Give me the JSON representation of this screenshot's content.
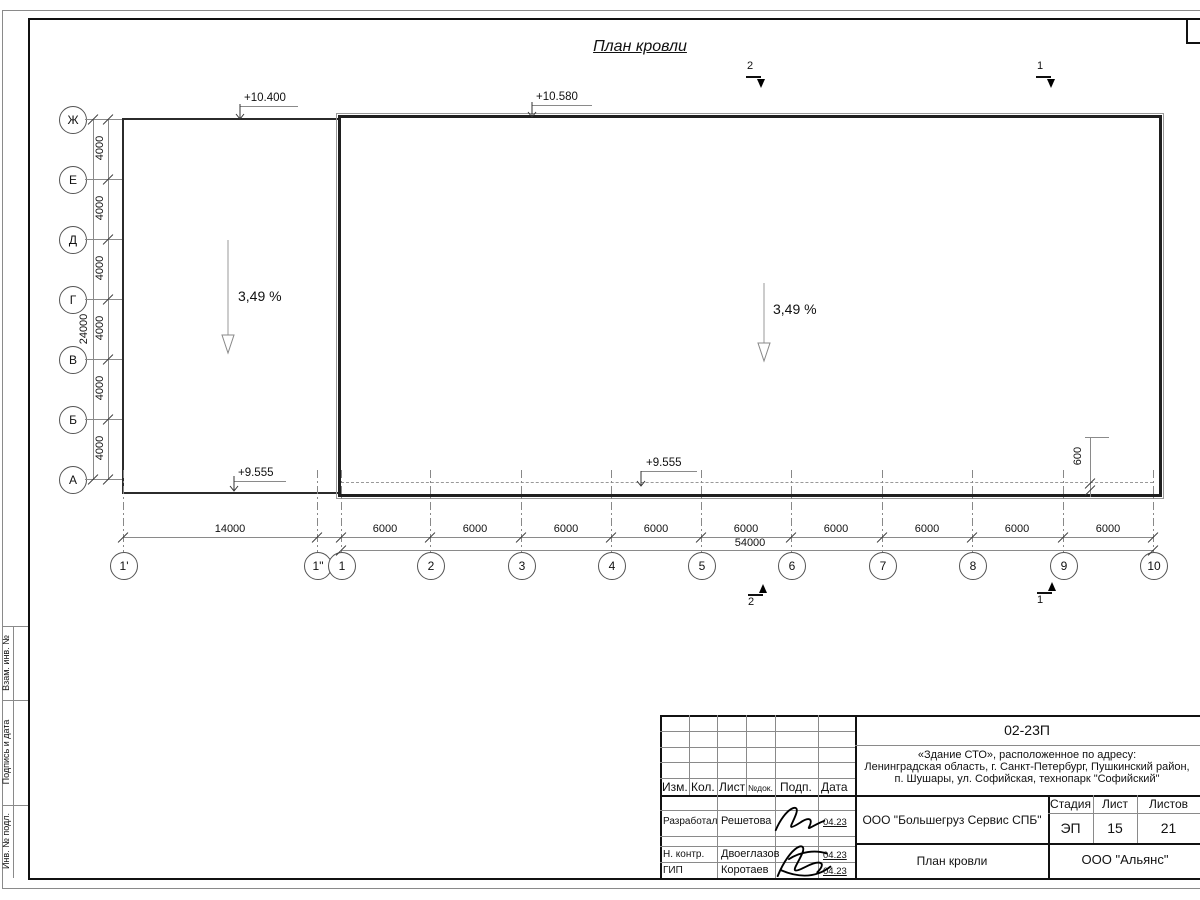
{
  "drawing": {
    "title": "План кровли"
  },
  "elevations": {
    "left_top": "+10.400",
    "main_top": "+10.580",
    "left_bottom": "+9.555",
    "main_bottom": "+9.555"
  },
  "slopes": {
    "left": "3,49 %",
    "right": "3,49 %"
  },
  "axes": {
    "letters": [
      "Ж",
      "Е",
      "Д",
      "Г",
      "В",
      "Б",
      "А"
    ],
    "numbers": [
      "1'",
      "1\"",
      "1",
      "2",
      "3",
      "4",
      "5",
      "6",
      "7",
      "8",
      "9",
      "10"
    ]
  },
  "dimensions": {
    "vertical_segments": [
      "4000",
      "4000",
      "4000",
      "4000",
      "4000",
      "4000"
    ],
    "vertical_total": "24000",
    "first_bay": "14000",
    "bays": [
      "6000",
      "6000",
      "6000",
      "6000",
      "6000",
      "6000",
      "6000",
      "6000",
      "6000"
    ],
    "total": "54000",
    "overhang": "600"
  },
  "section_marks": {
    "top_left": "2",
    "top_right": "1",
    "bottom_left": "2",
    "bottom_right": "1"
  },
  "frame_strip": {
    "vzam": "Взам. инв. №",
    "podpis": "Подпись и дата",
    "inv": "Инв. № подл."
  },
  "title_block": {
    "doc_number": "02-23П",
    "project_line1": "«Здание СТО», расположенное по адресу:",
    "project_line2": "Ленинградская область, г. Санкт-Петербург, Пушкинский район,",
    "project_line3": "п. Шушары, ул. Софийская, технопарк \"Софийский\"",
    "columns": [
      "Изм.",
      "Кол.",
      "Лист",
      "№док.",
      "Подп.",
      "Дата"
    ],
    "rows": [
      {
        "role": "Разработал",
        "name": "Решетова",
        "date": "04.23"
      },
      {
        "role": "Н. контр.",
        "name": "Двоеглазов",
        "date": "04.23"
      },
      {
        "role": "ГИП",
        "name": "Коротаев",
        "date": "04.23"
      }
    ],
    "stage_label": "Стадия",
    "sheet_label": "Лист",
    "sheets_label": "Листов",
    "stage": "ЭП",
    "sheet": "15",
    "sheets": "21",
    "client": "ООО \"Большегруз Сервис СПБ\"",
    "drawing_name": "План кровли",
    "company": "ООО \"Альянс\""
  }
}
